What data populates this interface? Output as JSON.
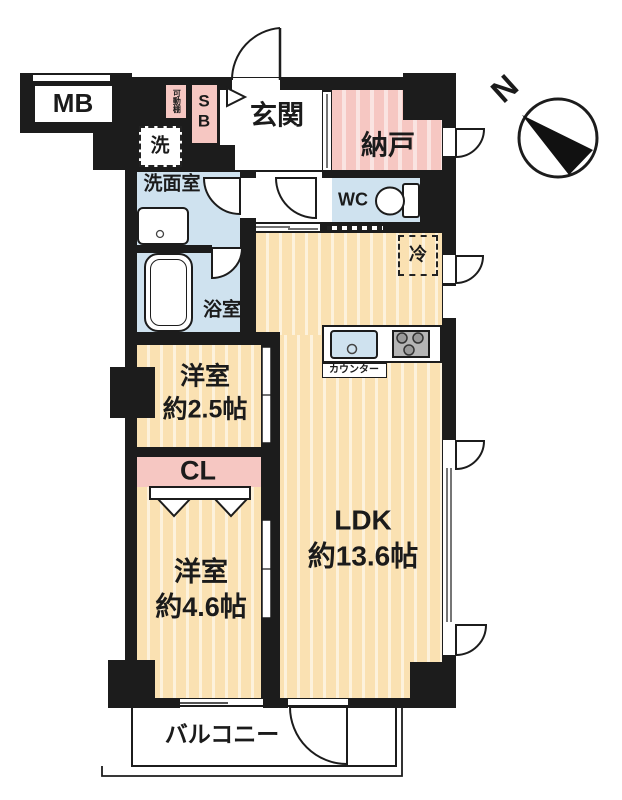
{
  "plan": {
    "compass": "N",
    "rooms": {
      "mb": "MB",
      "movable_shelf": "可動棚",
      "shoe_box": "SB",
      "entrance": "玄関",
      "storage": "納戸",
      "washer": "洗",
      "washroom": "洗面室",
      "toilet": "WC",
      "bathroom": "浴室",
      "fridge": "冷",
      "counter": "カウンター",
      "closet": "CL",
      "bedroom_small": {
        "name": "洋室",
        "size": "約2.5帖"
      },
      "bedroom": {
        "name": "洋室",
        "size": "約4.6帖"
      },
      "ldk": {
        "name": "LDK",
        "size": "約13.6帖"
      },
      "balcony": "バルコニー"
    },
    "colors": {
      "wall": "#1c1c1c",
      "wood_floor": "#fae1b2",
      "storage_pink": "#f6c7c2",
      "wet_area_blue": "#cfe2ef"
    }
  }
}
